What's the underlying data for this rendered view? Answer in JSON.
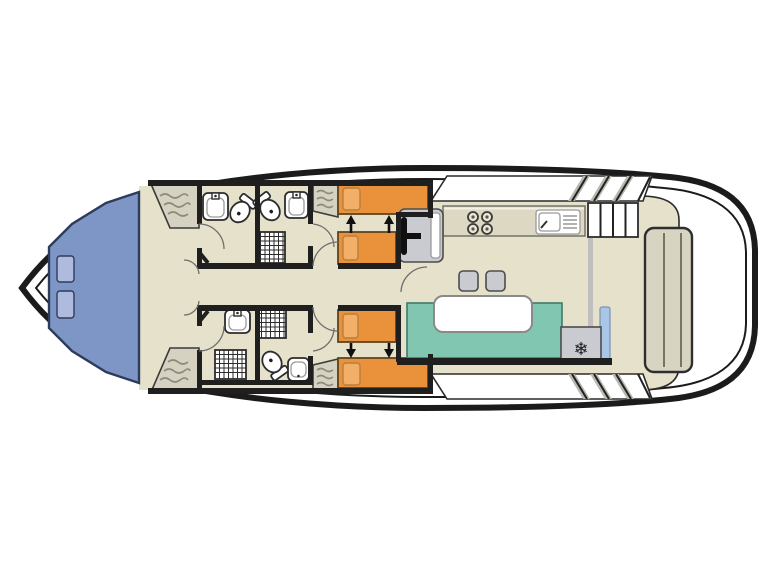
{
  "diagram": {
    "kind": "boat-deck-floor-plan",
    "colors": {
      "page_bg": "#ffffff",
      "hull_stroke": "#1b1b1b",
      "hull_fill": "#ffffff",
      "floor": "#e6e1cb",
      "wall": "#1f1f1f",
      "bed_blue": "#7e96c6",
      "pillow_blue": "#aebbde",
      "bed_orange": "#e9923b",
      "pillow_orange": "#f1af67",
      "seating_teal": "#80c6b1",
      "gray_fixture": "#c9cbd1",
      "counter": "#ddd8c3",
      "wardrobe": "#d6d2c2",
      "aft_bench": "#d8d4c2",
      "glass_blue": "#a9c6e6"
    },
    "icons": {
      "fridge_snowflake": "❄"
    }
  }
}
